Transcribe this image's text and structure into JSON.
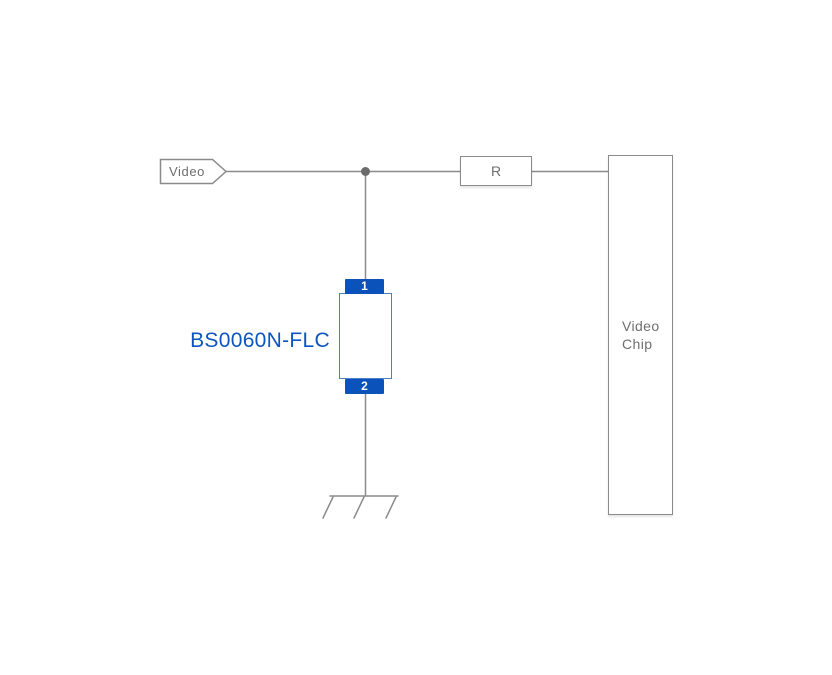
{
  "schematic": {
    "net_tag": {
      "label": "Video"
    },
    "resistor": {
      "label": "R"
    },
    "chip": {
      "label_line1": "Video",
      "label_line2": "Chip"
    },
    "tvs": {
      "part_number": "BS0060N-FLC",
      "pin_top": "1",
      "pin_bottom": "2"
    },
    "colors": {
      "background": "#ffffff",
      "wire_gray": "#8b8b8b",
      "junction_gray": "#6b6b6b",
      "text_gray": "#6e6e6e",
      "part_label_blue": "#0d56c0",
      "pin_block_blue": "#0b53bb",
      "body_border_blue": "#4a7ec7",
      "symbol_line_blue": "#7aa4d9"
    }
  }
}
